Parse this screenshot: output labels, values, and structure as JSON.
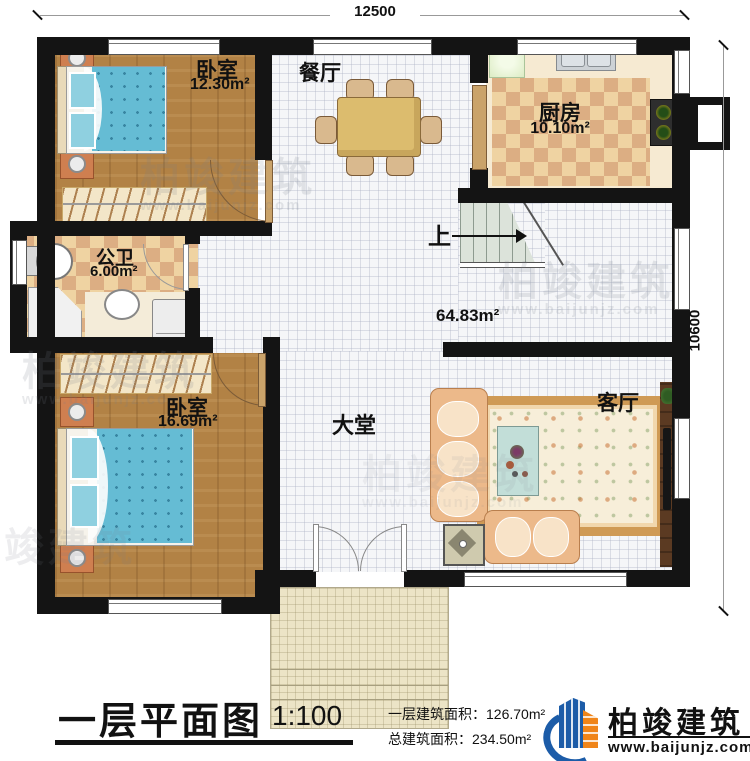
{
  "plan": {
    "dimensions": {
      "width_label": "12500",
      "height_label": "10600"
    },
    "rooms": {
      "bedroom_top": {
        "name": "卧室",
        "area": "12.30m²"
      },
      "dining": {
        "name": "餐厅"
      },
      "kitchen": {
        "name": "厨房",
        "area": "10.10m²"
      },
      "bathroom": {
        "name": "公卫",
        "area": "6.00m²"
      },
      "stairs": {
        "up_label": "上"
      },
      "hall": {
        "name": "大堂",
        "area": "64.83m²"
      },
      "bedroom_bottom": {
        "name": "卧室",
        "area": "16.69m²"
      },
      "living": {
        "name": "客厅"
      }
    }
  },
  "title_block": {
    "title": "一层平面图",
    "scale": "1:100",
    "floor_area": "一层建筑面积：126.70m²",
    "total_area": "总建筑面积：234.50m²"
  },
  "branding": {
    "name": "柏竣建筑",
    "website": "www.baijunjz.com"
  },
  "watermark": {
    "name": "柏竣建筑",
    "website": "www.baijunjz.com"
  },
  "colors": {
    "wall": "#141414",
    "wood": "#b28245",
    "tile": "#f5f6f8",
    "checker_light": "#efd3a2",
    "checker_dark": "#dcae83",
    "blanket_teal": "#65bcd4",
    "sofa_tan": "#ecb98a",
    "logo_blue": "#1c5ca8",
    "logo_orange": "#f08519"
  }
}
